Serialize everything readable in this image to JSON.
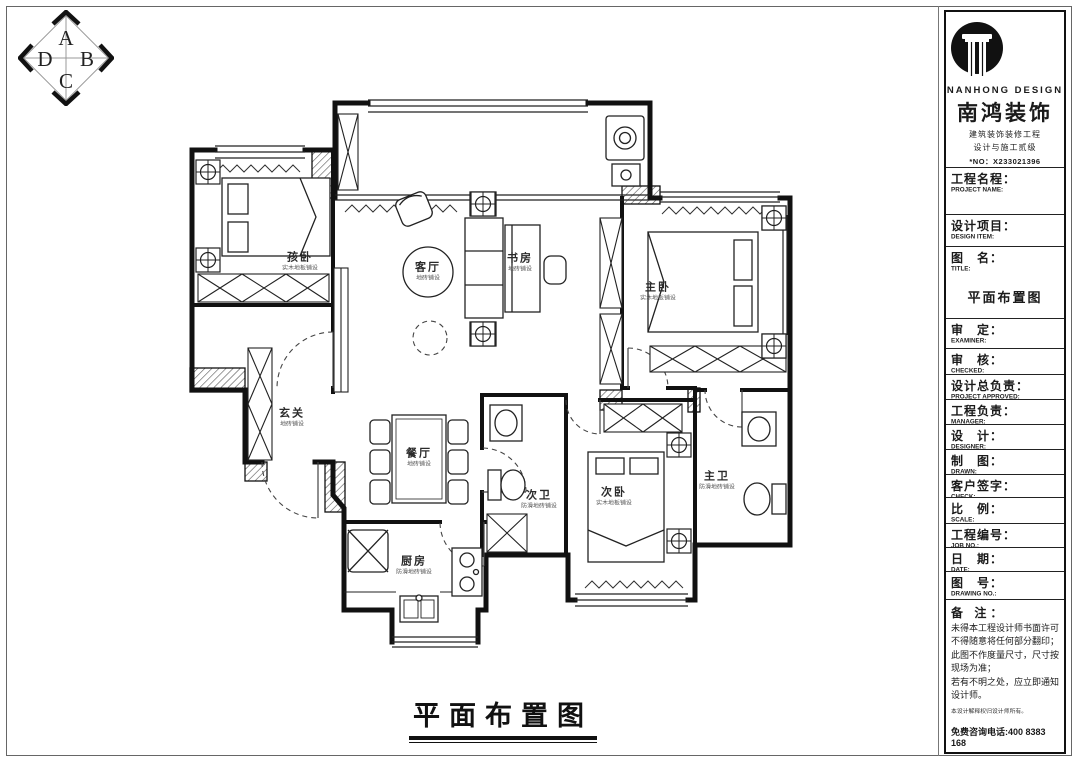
{
  "compass": {
    "letters": [
      "A",
      "B",
      "C",
      "D"
    ]
  },
  "plan": {
    "caption": "平面布置图",
    "rooms": [
      {
        "name": "孩卧",
        "finish": "实木地板铺设"
      },
      {
        "name": "客厅",
        "finish": "地砖铺设"
      },
      {
        "name": "书房",
        "finish": "地砖铺设"
      },
      {
        "name": "主卧",
        "finish": "实木地板铺设"
      },
      {
        "name": "玄关",
        "finish": "地砖铺设"
      },
      {
        "name": "餐厅",
        "finish": "地砖铺设"
      },
      {
        "name": "次卫",
        "finish": "防滑地砖铺设"
      },
      {
        "name": "次卧",
        "finish": "实木地板铺设"
      },
      {
        "name": "主卫",
        "finish": "防滑地砖铺设"
      },
      {
        "name": "厨房",
        "finish": "防滑地砖铺设"
      }
    ]
  },
  "titleblock": {
    "brand": {
      "en": "NANHONG DESIGN",
      "cn": "南鸿装饰",
      "line1": "建筑装饰装修工程",
      "line2": "设计与施工贰级",
      "license": "*NO：X233021396"
    },
    "drawing_title": "平面布置图",
    "fields": [
      {
        "label": "工程名程：",
        "sub": "PROJECT NAME:"
      },
      {
        "label": "设计项目：",
        "sub": "DESIGN ITEM:"
      },
      {
        "label": "图　名：",
        "sub": "TITLE:"
      },
      {
        "label": "审　定：",
        "sub": "EXAMINER:"
      },
      {
        "label": "审　核：",
        "sub": "CHECKED:"
      },
      {
        "label": "设计总负责：",
        "sub": "PROJECT APPROVED:"
      },
      {
        "label": "工程负责：",
        "sub": "MANAGER:"
      },
      {
        "label": "设　计：",
        "sub": "DESIGNER:"
      },
      {
        "label": "制　图：",
        "sub": "DRAWN:"
      },
      {
        "label": "客户签字：",
        "sub": "CHECK:"
      },
      {
        "label": "比　例：",
        "sub": "SCALE:"
      },
      {
        "label": "工程编号：",
        "sub": "JOB NO.:"
      },
      {
        "label": "日　期：",
        "sub": "DATE:"
      },
      {
        "label": "图　号：",
        "sub": "DRAWING NO.:"
      }
    ],
    "remarks": {
      "label": "备  注：",
      "lines": [
        "未得本工程设计师书面许可不得随意将任何部分翻印；",
        "此图不作度量尺寸，尺寸按现场为准；",
        "若有不明之处，应立即通知设计师。"
      ],
      "fine_print": "本设计解释权归设计师所有。",
      "phone": "免费咨询电话:400 8383 168"
    }
  }
}
